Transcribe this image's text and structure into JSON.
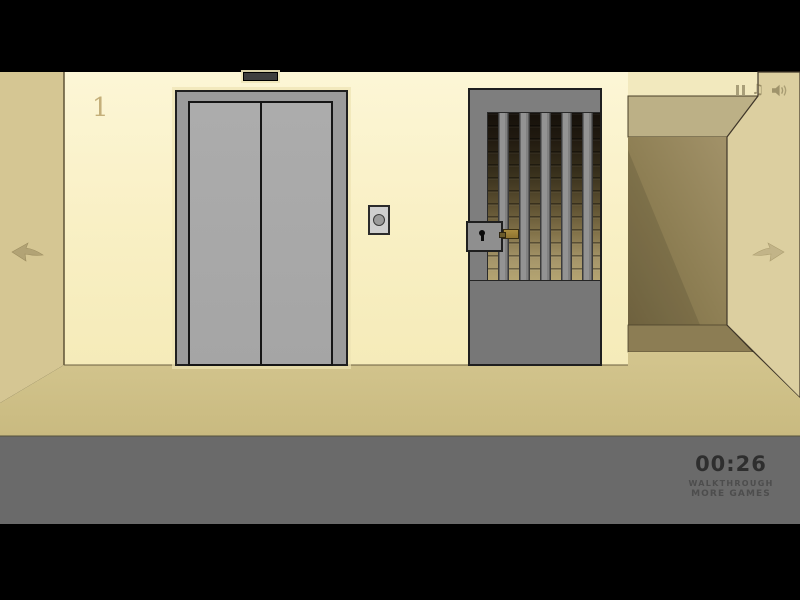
{
  "scene": {
    "floor_number": "1"
  },
  "hud": {
    "timer": "00:26",
    "walkthrough_label": "WALKTHROUGH",
    "more_games_label": "MORE GAMES"
  },
  "icons": {
    "music_glyph": "♫",
    "pause": "pause-icon",
    "sound": "speaker-icon",
    "nav_left": "arrow-left-icon",
    "nav_right": "arrow-right-icon"
  },
  "colors": {
    "letterbox": "#000000",
    "main_wall": "#F9F0C5",
    "left_side_wall": "#D5C693",
    "right_side_wall": "#DCCFA0",
    "alcove_ceiling": "#BCB086",
    "alcove_back": "#8D7E53",
    "alcove_floor": "#8C7D54",
    "floor": "#CDBE85",
    "foreground": "#6A6A6A",
    "elevator_frame": "#9B9B9B",
    "elevator_door": "#A9A9A9",
    "gate_gray": "#7E7E7E",
    "latch_brass": "#9A7D36",
    "timer_text": "#2E2E2E"
  }
}
